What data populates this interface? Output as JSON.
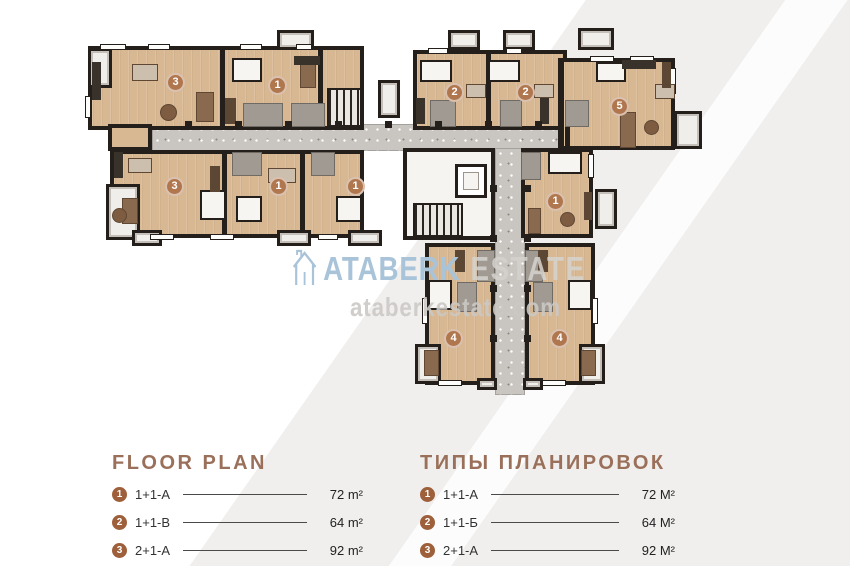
{
  "watermark": {
    "brand_first": "ATABERK",
    "brand_second": "ESTATE",
    "domain": "ataberkestate.com"
  },
  "legend_left": {
    "title": "FLOOR PLAN",
    "items": [
      {
        "num": "1",
        "label": "1+1-A",
        "area": "72 m²"
      },
      {
        "num": "2",
        "label": "1+1-B",
        "area": "64 m²"
      },
      {
        "num": "3",
        "label": "2+1-A",
        "area": "92 m²"
      }
    ]
  },
  "legend_right": {
    "title": "ТИПЫ ПЛАНИРОВОК",
    "items": [
      {
        "num": "1",
        "label": "1+1-А",
        "area": "72 М²"
      },
      {
        "num": "2",
        "label": "1+1-Б",
        "area": "64 М²"
      },
      {
        "num": "3",
        "label": "2+1-А",
        "area": "92 М²"
      }
    ]
  },
  "colors": {
    "accent_brown": "#9a705a",
    "legend_badge_brown": "#9e5f3b",
    "plan_badge_brown": "#b0774f",
    "floor_tan": "#d8b893",
    "wall_dark": "#241f1a",
    "corridor_gray": "#c9c5c1",
    "watermark_blue": "#a9c3d9"
  },
  "plan": {
    "corridors": [
      [
        152,
        124,
        413,
        27
      ],
      [
        495,
        148,
        30,
        247
      ]
    ],
    "rooms": [
      [
        88,
        46,
        276,
        84
      ],
      [
        110,
        150,
        254,
        88
      ],
      [
        413,
        50,
        154,
        80
      ],
      [
        560,
        58,
        115,
        92
      ],
      [
        521,
        148,
        72,
        90
      ],
      [
        425,
        243,
        70,
        142
      ],
      [
        525,
        243,
        70,
        142
      ]
    ],
    "patches": [
      [
        108,
        124,
        44,
        27
      ]
    ],
    "core": [
      403,
      148,
      92,
      92
    ],
    "partitions": [
      [
        220,
        46,
        5,
        84
      ],
      [
        318,
        46,
        5,
        84
      ],
      [
        486,
        50,
        5,
        80
      ],
      [
        558,
        58,
        5,
        92
      ],
      [
        222,
        150,
        5,
        88
      ],
      [
        300,
        150,
        5,
        88
      ],
      [
        565,
        124,
        5,
        27
      ]
    ],
    "bathrooms": [
      [
        243,
        103,
        40,
        24
      ],
      [
        291,
        103,
        34,
        24
      ],
      [
        430,
        100,
        26,
        27
      ],
      [
        500,
        100,
        22,
        27
      ],
      [
        565,
        100,
        24,
        27
      ],
      [
        232,
        152,
        30,
        24
      ],
      [
        311,
        152,
        24,
        24
      ],
      [
        521,
        152,
        20,
        28
      ],
      [
        457,
        282,
        20,
        30
      ],
      [
        533,
        282,
        20,
        30
      ],
      [
        477,
        250,
        18,
        32
      ],
      [
        525,
        250,
        18,
        32
      ]
    ],
    "stairs": [
      [
        327,
        88,
        35,
        39
      ],
      [
        413,
        203,
        50,
        34
      ]
    ],
    "elevator": [
      455,
      164,
      32,
      34
    ],
    "balconies": [
      [
        277,
        30,
        37,
        20
      ],
      [
        88,
        48,
        24,
        40
      ],
      [
        106,
        184,
        34,
        56
      ],
      [
        132,
        230,
        30,
        16
      ],
      [
        277,
        230,
        34,
        16
      ],
      [
        348,
        230,
        34,
        16
      ],
      [
        448,
        30,
        32,
        20
      ],
      [
        503,
        30,
        32,
        20
      ],
      [
        578,
        28,
        36,
        22
      ],
      [
        378,
        80,
        22,
        38
      ],
      [
        674,
        111,
        28,
        38
      ],
      [
        595,
        189,
        22,
        40
      ],
      [
        415,
        344,
        26,
        40
      ],
      [
        579,
        344,
        26,
        40
      ],
      [
        477,
        378,
        20,
        12
      ],
      [
        523,
        378,
        20,
        12
      ]
    ],
    "windows": [
      [
        100,
        44,
        26,
        6
      ],
      [
        148,
        44,
        22,
        6
      ],
      [
        240,
        44,
        22,
        6
      ],
      [
        296,
        44,
        16,
        6
      ],
      [
        428,
        48,
        20,
        6
      ],
      [
        506,
        48,
        16,
        6
      ],
      [
        590,
        56,
        24,
        6
      ],
      [
        630,
        56,
        24,
        6
      ],
      [
        85,
        96,
        6,
        22
      ],
      [
        150,
        234,
        24,
        6
      ],
      [
        210,
        234,
        24,
        6
      ],
      [
        318,
        234,
        20,
        6
      ],
      [
        670,
        68,
        6,
        26
      ],
      [
        588,
        154,
        6,
        24
      ],
      [
        438,
        380,
        24,
        6
      ],
      [
        542,
        380,
        24,
        6
      ],
      [
        422,
        298,
        6,
        26
      ],
      [
        592,
        298,
        6,
        26
      ]
    ],
    "columns": [
      [
        185,
        121,
        7,
        7
      ],
      [
        235,
        121,
        7,
        7
      ],
      [
        285,
        121,
        7,
        7
      ],
      [
        335,
        121,
        7,
        7
      ],
      [
        385,
        121,
        7,
        7
      ],
      [
        435,
        121,
        7,
        7
      ],
      [
        485,
        121,
        7,
        7
      ],
      [
        535,
        121,
        7,
        7
      ],
      [
        490,
        185,
        7,
        7
      ],
      [
        490,
        235,
        7,
        7
      ],
      [
        490,
        285,
        7,
        7
      ],
      [
        490,
        335,
        7,
        7
      ],
      [
        524,
        185,
        7,
        7
      ],
      [
        524,
        235,
        7,
        7
      ],
      [
        524,
        285,
        7,
        7
      ],
      [
        524,
        335,
        7,
        7
      ]
    ],
    "furniture": {
      "bed": [
        [
          232,
          58,
          30,
          24
        ],
        [
          420,
          60,
          32,
          22
        ],
        [
          488,
          60,
          32,
          22
        ],
        [
          596,
          62,
          30,
          20
        ],
        [
          200,
          190,
          26,
          30
        ],
        [
          236,
          196,
          26,
          26
        ],
        [
          336,
          196,
          26,
          26
        ],
        [
          548,
          152,
          34,
          22
        ],
        [
          428,
          280,
          24,
          30
        ],
        [
          568,
          280,
          24,
          30
        ]
      ],
      "sofa": [
        [
          196,
          92,
          18,
          30
        ],
        [
          122,
          198,
          16,
          26
        ],
        [
          620,
          112,
          16,
          36
        ],
        [
          528,
          208,
          13,
          26
        ],
        [
          424,
          350,
          15,
          26
        ],
        [
          581,
          350,
          15,
          26
        ],
        [
          300,
          62,
          16,
          26
        ]
      ],
      "table": [
        [
          160,
          104,
          17,
          17
        ],
        [
          112,
          208,
          15,
          15
        ],
        [
          644,
          120,
          15,
          15
        ],
        [
          560,
          212,
          15,
          15
        ]
      ],
      "dining": [
        [
          132,
          64,
          26,
          17
        ],
        [
          128,
          158,
          24,
          15
        ],
        [
          268,
          168,
          28,
          15
        ],
        [
          466,
          84,
          20,
          14
        ],
        [
          534,
          84,
          20,
          14
        ],
        [
          655,
          84,
          20,
          15
        ]
      ],
      "wardrobe": [
        [
          225,
          98,
          11,
          26
        ],
        [
          210,
          166,
          10,
          26
        ],
        [
          584,
          192,
          8,
          28
        ],
        [
          662,
          62,
          9,
          26
        ],
        [
          455,
          250,
          10,
          22
        ],
        [
          538,
          250,
          10,
          22
        ]
      ],
      "counter": [
        [
          92,
          62,
          9,
          38
        ],
        [
          294,
          56,
          26,
          9
        ],
        [
          416,
          98,
          9,
          26
        ],
        [
          540,
          98,
          9,
          26
        ],
        [
          622,
          60,
          34,
          9
        ],
        [
          114,
          152,
          9,
          26
        ]
      ]
    },
    "badges": [
      {
        "n": "3",
        "x": 175,
        "y": 82
      },
      {
        "n": "1",
        "x": 277,
        "y": 85
      },
      {
        "n": "2",
        "x": 454,
        "y": 92
      },
      {
        "n": "2",
        "x": 525,
        "y": 92
      },
      {
        "n": "5",
        "x": 619,
        "y": 106
      },
      {
        "n": "3",
        "x": 174,
        "y": 186
      },
      {
        "n": "1",
        "x": 278,
        "y": 186
      },
      {
        "n": "1",
        "x": 355,
        "y": 186
      },
      {
        "n": "1",
        "x": 555,
        "y": 201
      },
      {
        "n": "4",
        "x": 453,
        "y": 338
      },
      {
        "n": "4",
        "x": 559,
        "y": 338
      }
    ]
  }
}
